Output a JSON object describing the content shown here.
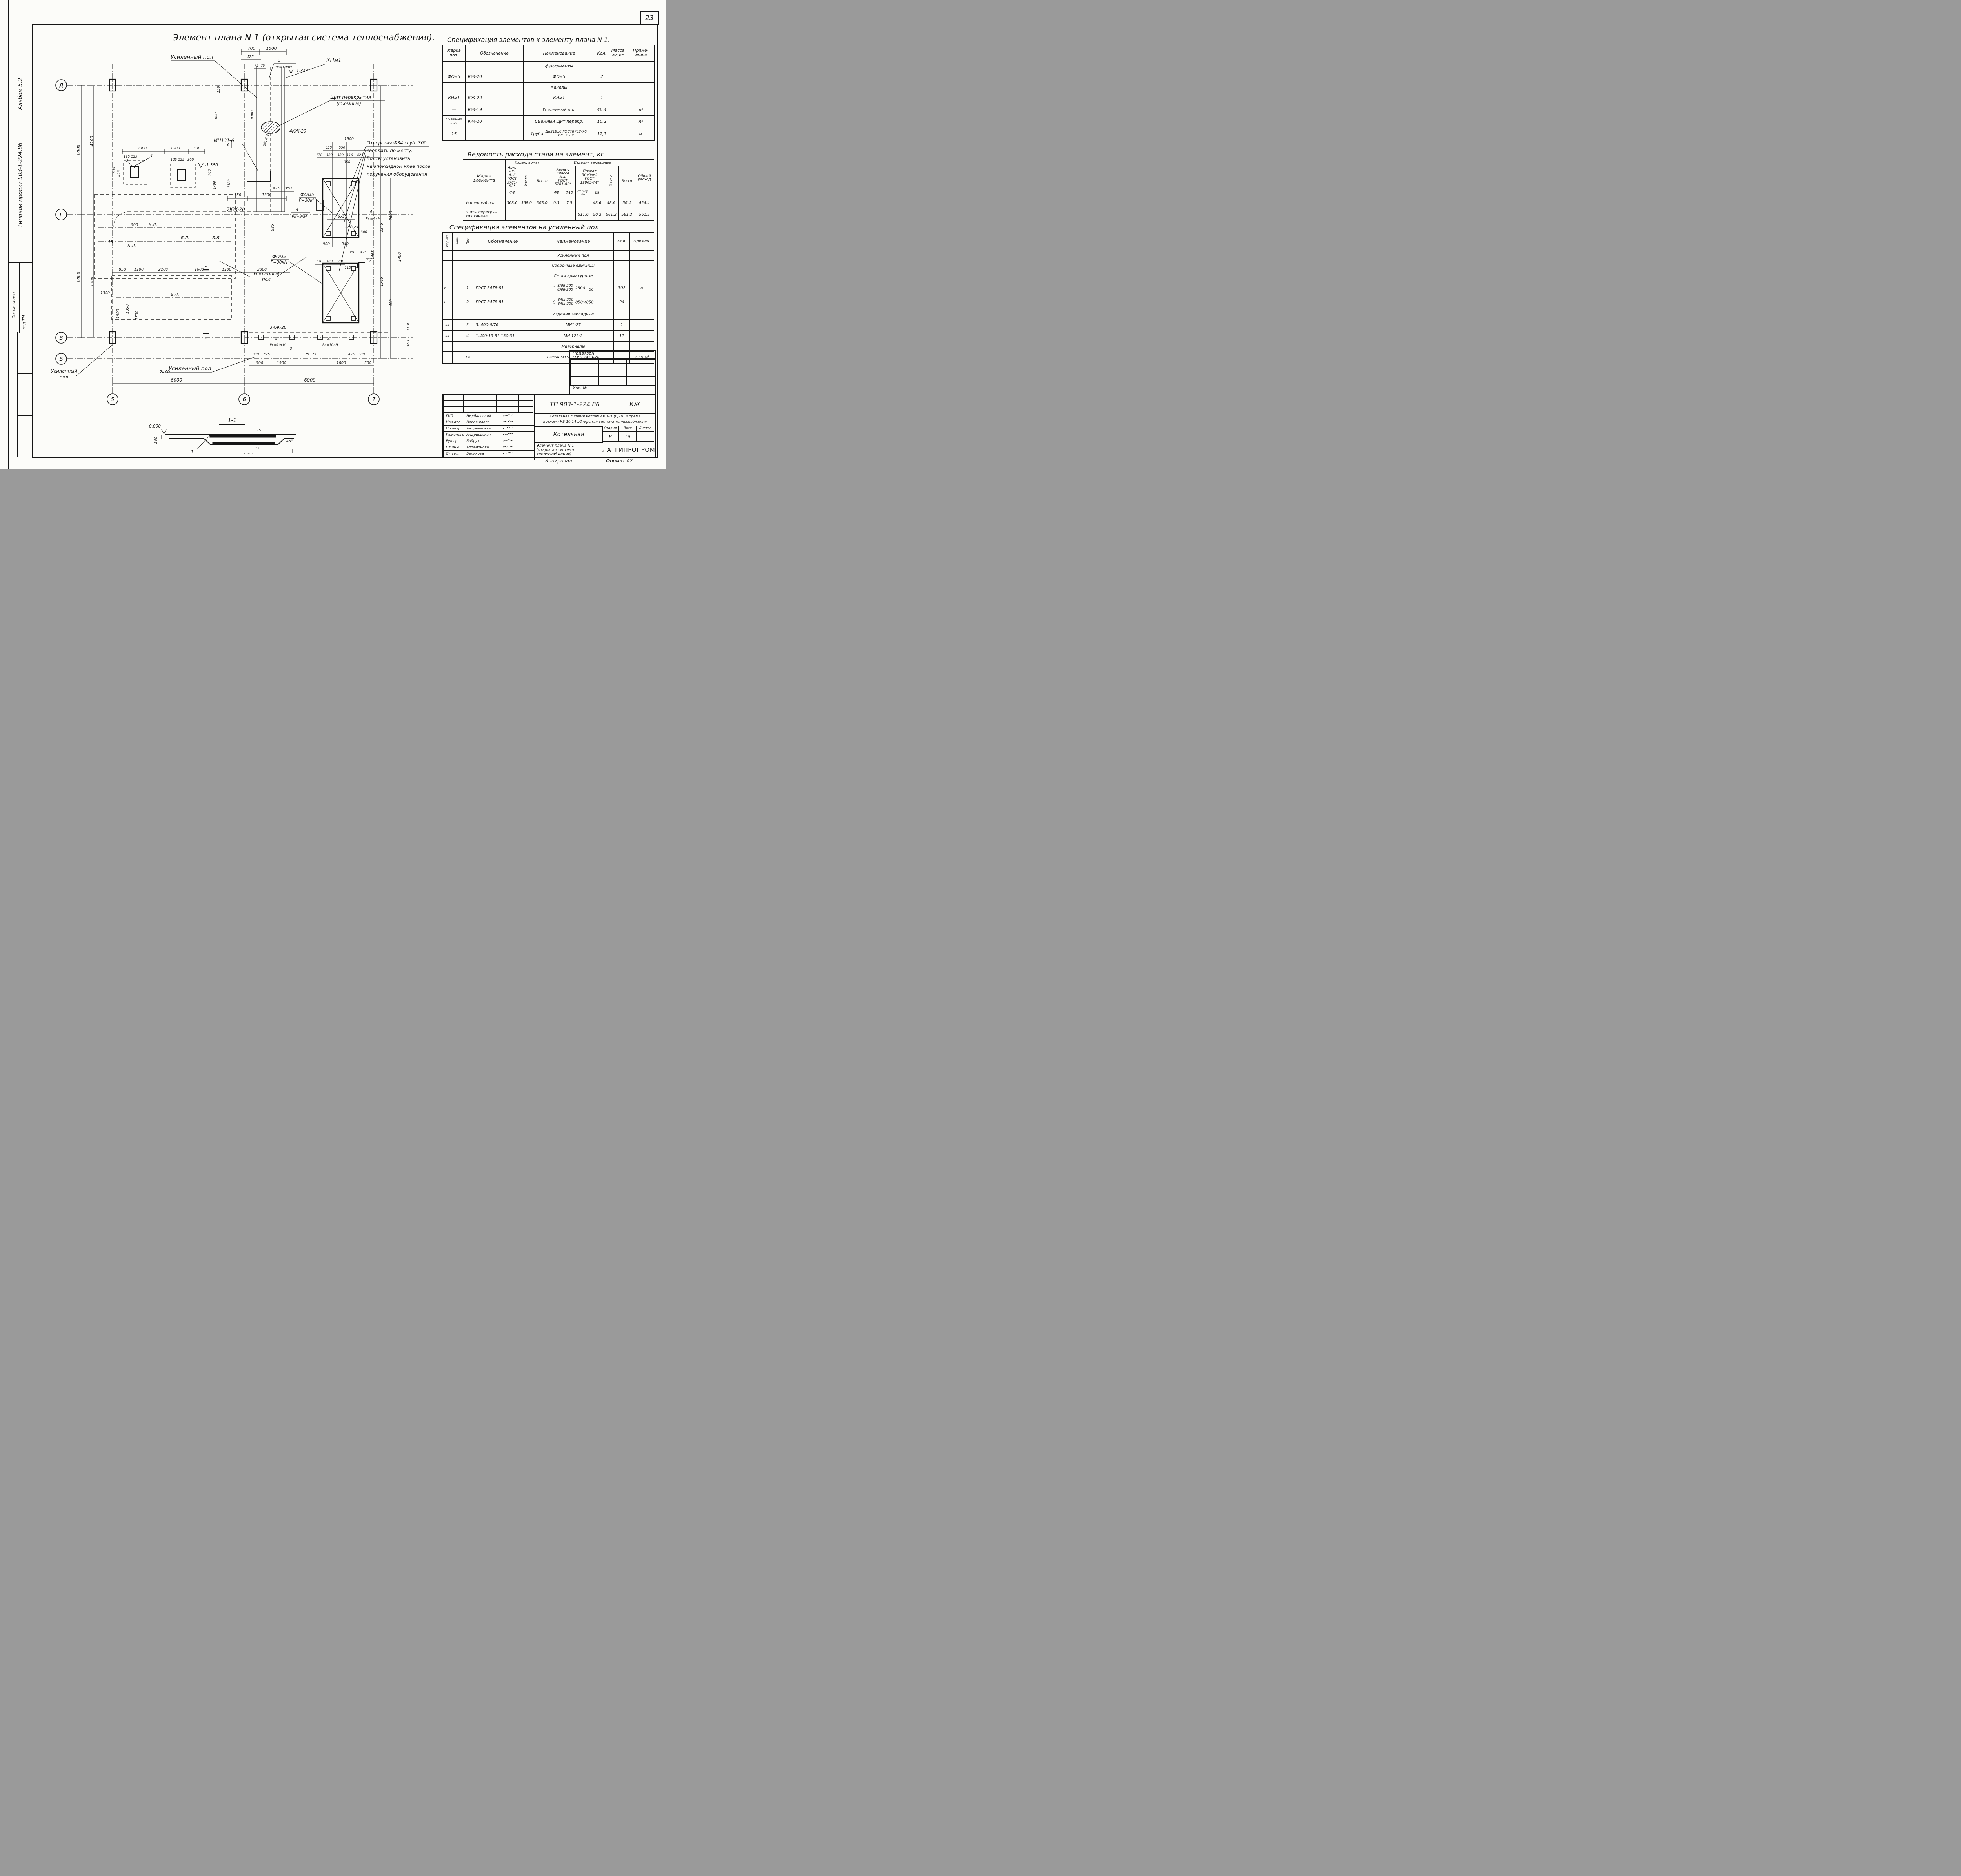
{
  "page": {
    "number": "23",
    "copied_label": "Копировал",
    "format_label": "Формат А2"
  },
  "sidebar": {
    "album": "Альбом 5.2",
    "project": "Типовой проект 903-1-224.86",
    "agreed": "Согласовано",
    "dept": "отд ТМ"
  },
  "plan": {
    "title": "Элемент плана N 1 (открытая система теплоснабжения).",
    "axes": {
      "h": [
        "Д",
        "Г",
        "В",
        "Б"
      ],
      "v": [
        "5",
        "6",
        "7"
      ]
    },
    "a": {
      "usp": "Усиленный пол",
      "usp_l1": "Усиленный",
      "usp_l2": "пол",
      "knm1": "КНм1",
      "shield1": "Щит перекрытия",
      "shield2": "(съемные)",
      "mn131": "МН131-6",
      "fom5": "ФОм5",
      "p30": "Р=30кН",
      "kj6": "6КЖ-20",
      "kj7": "7КЖ-20",
      "kj4": "4КЖ-20",
      "kj3": "3КЖ-20",
      "bl": "Б.Л.",
      "t2": "Т2",
      "pipe15": "15",
      "slope": "0.002",
      "elev1": "-1.344",
      "elev2": "-1.380",
      "n3": "3",
      "n4": "4",
      "n1": "1",
      "n6": "6",
      "pk10": "Рк=10кН",
      "pk9": "Рк=9кН",
      "note1": "Отверстия Ф34 глуб. 300",
      "note2": "сверлить по месту.",
      "note3": "Болты установить",
      "note4": "на эпоксидном клее после",
      "note5": "получения оборудования"
    },
    "dims": [
      "700",
      "1500",
      "425",
      "75",
      "75",
      "150",
      "600",
      "2000",
      "1200",
      "300",
      "125",
      "125",
      "425",
      "300",
      "125",
      "125",
      "300",
      "700",
      "1400",
      "1180",
      "750",
      "1300",
      "4200",
      "6000",
      "6000",
      "1700",
      "1300",
      "1900",
      "550",
      "550",
      "170",
      "380",
      "380",
      "110",
      "425",
      "350",
      "425",
      "350",
      "585",
      "675",
      "900",
      "940",
      "350",
      "425",
      "170",
      "380",
      "380",
      "110",
      "125",
      "125",
      "300",
      "2345",
      "2600",
      "1400",
      "1765",
      "1465",
      "400",
      "850",
      "1100",
      "2200",
      "1600",
      "1100",
      "2800",
      "500",
      "1900",
      "1350",
      "1700",
      "2400",
      "300",
      "425",
      "125",
      "125",
      "425",
      "300",
      "500",
      "1900",
      "1800",
      "500",
      "6000",
      "6000",
      "1100",
      "360"
    ],
    "section": {
      "title": "1-1",
      "elev": "0.000",
      "d1": "300",
      "d2": "15",
      "d3": "15",
      "d4": "2350",
      "d5": "45°"
    }
  },
  "spec1": {
    "title": "Спецификация элементов к элементу плана N 1.",
    "col": [
      "Марка\nпоз.",
      "Обозначение",
      "Наименование",
      "Кол.",
      "Масса\nед,кг",
      "Приме-\nчание"
    ],
    "r0": {
      "name": "фундаменты"
    },
    "r1": {
      "mark": "ФОм5",
      "des": "КЖ-20",
      "name": "ФОм5",
      "qty": "2"
    },
    "r2": {
      "name": "Каналы"
    },
    "r3": {
      "mark": "КНм1",
      "des": "КЖ-20",
      "name": "КНм1",
      "qty": "1"
    },
    "r4": {
      "mark": "—",
      "des": "КЖ-19",
      "name": "Усиленный пол",
      "qty": "46,4",
      "note": "м²"
    },
    "r5": {
      "mark": "Съемный\nщит",
      "des": "КЖ-20",
      "name": "Съемный щит перекр.",
      "qty": "10,2",
      "note": "м²"
    },
    "r6": {
      "mark": "15",
      "pre": "Труба",
      "top": "Дн219x6 ГОСТ8732-70",
      "bot": "ВСт3сп2",
      "qty": "12,1",
      "note": "м"
    }
  },
  "steel": {
    "title": "Ведомость расхода стали на элемент, кг",
    "h_mark": "Марка\nэлемента",
    "g1": "Издел. армат.",
    "g2": "Изделия закладные",
    "g1_cls": "Арм. кл.\nА-III\nГОСТ\n5781-82*",
    "g2_cls": "Армат.\nкласса\nА-III\nГОСТ\n5781-82*",
    "g2_prokat": "Прокат\nВСт3кп2\nГОСТ\n19903-74*",
    "itogo": "Итого",
    "vsego": "Всего",
    "d8a": "Ф8",
    "d8z": "Ф8",
    "d10": "Ф10",
    "rif": "ст.риф.\nδ6",
    "t8": "δ8",
    "total": "Общий\nрасход",
    "rows": [
      {
        "mark": "Усиленный пол",
        "c": [
          "368,0",
          "368,0",
          "368,0",
          "0,3",
          "7,5",
          "",
          "48,6",
          "48,6",
          "56,4",
          "424,4"
        ]
      },
      {
        "mark": "Щиты перекры-\nтия канала",
        "c": [
          "",
          "",
          "",
          "",
          "",
          "511,0",
          "50,2",
          "561,2",
          "561,2",
          "561,2"
        ]
      }
    ]
  },
  "spec2": {
    "title": "Спецификация элементов на усиленный пол.",
    "col_fmt": "Формат",
    "col_zone": "Зона",
    "col_poz": "Поз.",
    "col_des": "Обозначение",
    "col_name": "Наименование",
    "col_qty": "Кол.",
    "col_note": "Примеч.",
    "sec1": "Усиленный пол",
    "sec2": "Сборочные единицы",
    "sec3": "Сетки арматурные",
    "sec4": "Изделия закладные",
    "sec5": "Материалы",
    "r1": {
      "fmt": "Б.Ч.",
      "poz": "1",
      "des": "ГОСТ 8478-81",
      "pre": "С",
      "top": "8АIII-200",
      "bot": "8АIII-200",
      "suf": "2300",
      "xtop": "—",
      "xbot": "50",
      "qty": "302",
      "note": "м"
    },
    "r2": {
      "fmt": "Б.Ч.",
      "poz": "2",
      "des": "ГОСТ 8478-81",
      "pre": "С",
      "top": "8АIII-200",
      "bot": "8АIII-200",
      "suf": "850×850",
      "qty": "24"
    },
    "r3": {
      "fmt": "А4",
      "poz": "3",
      "des": "З. 400-6/76",
      "name": "МИ1-27",
      "qty": "1"
    },
    "r4": {
      "fmt": "А4",
      "poz": "4",
      "des": "1.400-15 81.130-31",
      "name": "МН 122-2",
      "qty": "11"
    },
    "r5": {
      "poz": "14",
      "name": "Бетон М150 ГОСТ7473-76",
      "note": "13,9 м³"
    }
  },
  "stamp": {
    "doc": "ТП 903-1-224.86",
    "code": "КЖ",
    "object1": "Котельная с тремя котлами КВ-ТС(В)-10 и тремя",
    "object2": "котлами КЕ-10-14с.Открытая система теплоснабжения",
    "building": "Котельная",
    "stage_l": "Стадия",
    "sheet_l": "Лист",
    "sheets_l": "Листов",
    "stage": "Р",
    "sheet": "19",
    "draw1": "Элемент плана N 1",
    "draw2": "(открытая система теплоснабжения)",
    "org": "ЛАТГИПРОПРОМ",
    "attached": "Привязан",
    "inv": "Инв. №",
    "roles": [
      {
        "r": "ГИП",
        "n": "Нидбальский"
      },
      {
        "r": "Нач.отд.",
        "n": "Новожилова"
      },
      {
        "r": "Н.контр.",
        "n": "Андриевская"
      },
      {
        "r": "Гл.констр.",
        "n": "Андриевская"
      },
      {
        "r": "Рук.гр.",
        "n": "Бобрук"
      },
      {
        "r": "Ст.инж.",
        "n": "Артамонова"
      },
      {
        "r": "Ст.тех.",
        "n": "Белякова"
      }
    ]
  }
}
